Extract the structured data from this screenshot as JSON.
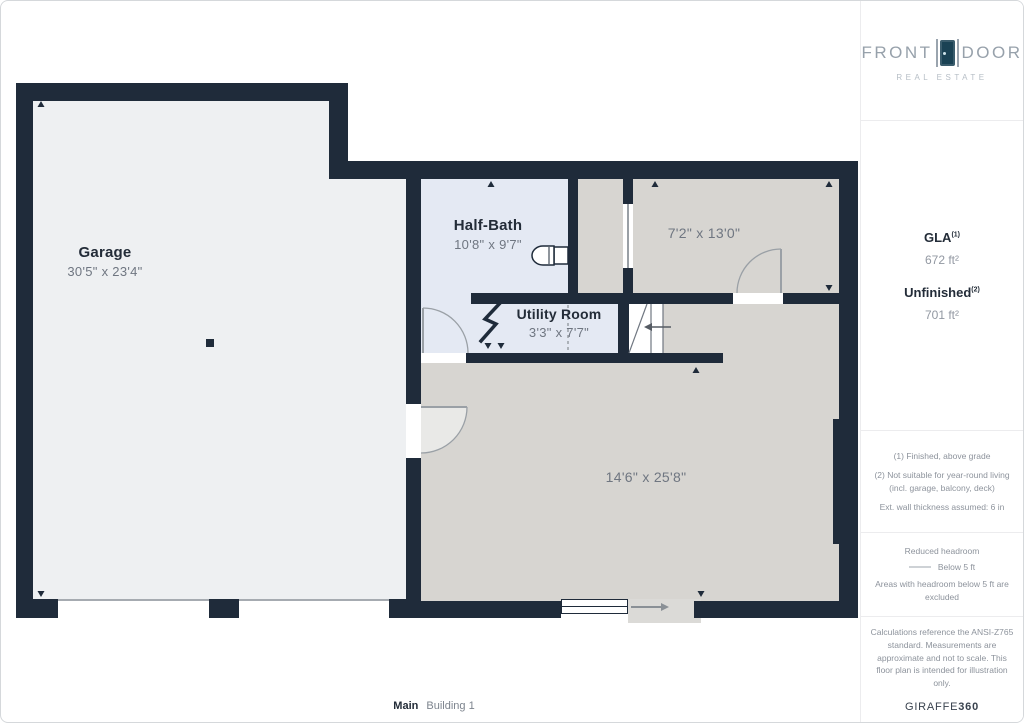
{
  "branding": {
    "name_part1": "FRONT",
    "name_part2": "DOOR",
    "tagline": "REAL ESTATE"
  },
  "floorplan": {
    "rooms": [
      {
        "name": "Garage",
        "dims": "30'5\" x 23'4\""
      },
      {
        "name": "Half-Bath",
        "dims": "10'8\" x 9'7\""
      },
      {
        "name": "Utility Room",
        "dims": "3'3\" x 7'7\""
      },
      {
        "name": "",
        "dims": "7'2\" x 13'0\""
      },
      {
        "name": "",
        "dims": "14'6\" x 25'8\""
      }
    ]
  },
  "stats": {
    "gla_label": "GLA",
    "gla_sup": "(1)",
    "gla_value": "672 ft²",
    "unfinished_label": "Unfinished",
    "unfinished_sup": "(2)",
    "unfinished_value": "701 ft²"
  },
  "notes": [
    "(1) Finished, above grade",
    "(2) Not suitable for year-round living (incl. garage, balcony, deck)",
    "Ext. wall thickness assumed: 6 in"
  ],
  "legend": {
    "title": "Reduced headroom",
    "item": "Below 5 ft",
    "note": "Areas with headroom below 5 ft are excluded"
  },
  "footer": {
    "disclaimer": "Calculations reference the ANSI-Z765 standard. Measurements are approximate and not to scale. This floor plan is intended for illustration only.",
    "brand": "GIRAFFE",
    "brand_suffix": "360"
  },
  "caption": {
    "level": "Main",
    "building": "Building 1"
  },
  "colors": {
    "wall": "#1f2b3a",
    "finished_room": "#e4e9f3",
    "unfinished_room": "#d7d5d1",
    "garage_floor": "#eef0f2",
    "brand_door": "#1a4254",
    "brand_text": "#97a1ab"
  }
}
